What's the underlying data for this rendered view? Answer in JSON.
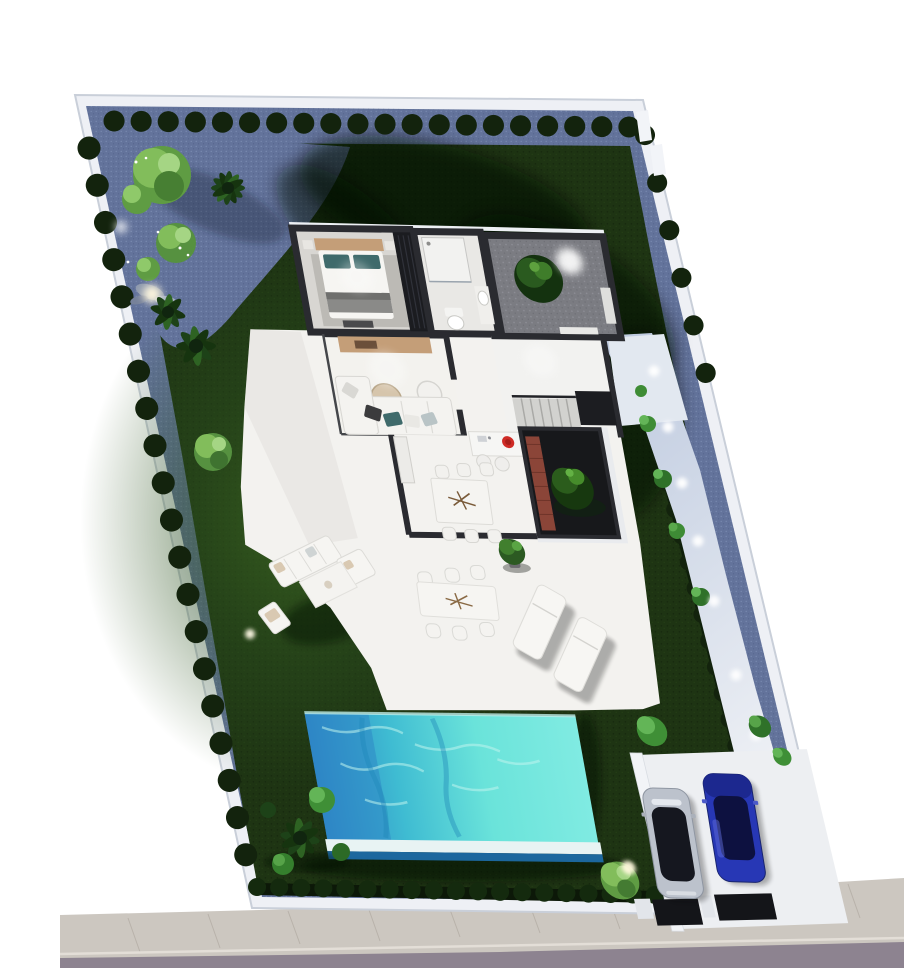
{
  "scene": {
    "description": "Aerial top-down 3D architectural render of a walled villa plot with garden, swimming pool, furnished interior, terrace and private parking",
    "view": "top-down dollhouse aerial view",
    "lighting": "dusk render with garden and wall spotlights",
    "visible_text": "none"
  },
  "palette": {
    "background": "#ffffff",
    "plot_wall": "#eef0f5",
    "gravel": "#63739b",
    "lawn": "#1e3413",
    "lawn_light": "#3c6621",
    "hedge": "#13230d",
    "tree_light": "#82bd5b",
    "tree_dark": "#10250f",
    "path_stone": "#c6d0e2",
    "terrace": "#f3f2ef",
    "house_wall": "#2a2b30",
    "bedroom_floor": "#d8d6d2",
    "courtyard_floor": "#7b7c82",
    "brick": "#8b4538",
    "wood": "#c49e78",
    "pool_deep": "#2e86c6",
    "pool_mid": "#3fbcd2",
    "pool_aqua": "#6ae3da",
    "pool_rim": "#e8f3f3",
    "sidewalk": "#ccc7c0",
    "road": "#8d8390",
    "car_silver": "#bcc2cc",
    "car_glass": "#15171f",
    "car_blue": "#2737b5",
    "cooktop_red": "#cf2b25",
    "pillow_teal": "#3f6a6b",
    "glow": "#ffffff"
  },
  "plot": {
    "shape": "parallelogram walled plot",
    "boundary_wall": "white perimeter wall",
    "perimeter_planting": "rows of clipped round hedge bushes along top and left walls",
    "side_path": "blue-grey stone path with wall lights along right boundary",
    "rock_garden": "gravel garden with clipped trees, rocks, palms and spotlights in top-left corner"
  },
  "house": {
    "rooms": [
      {
        "name": "bedroom",
        "furniture": [
          "double bed",
          "tan headboard",
          "teal pillows",
          "grey throw",
          "area rug",
          "nightstands",
          "foot bench",
          "dark wardrobe"
        ]
      },
      {
        "name": "bathroom",
        "furniture": [
          "walk-in shower",
          "washbasin counter",
          "toilet"
        ]
      },
      {
        "name": "entrance-courtyard",
        "features": [
          "gravel floor",
          "ornamental tree",
          "spotlight",
          "white doormat",
          "planter"
        ]
      },
      {
        "name": "living-room",
        "furniture": [
          "wood media sideboard",
          "round pouf table",
          "round side table",
          "armchair",
          "L-shaped white sofa",
          "scatter cushions"
        ]
      },
      {
        "name": "hall",
        "furniture": [
          "staircase with dark landing",
          "railing"
        ]
      },
      {
        "name": "kitchen",
        "furniture": [
          "white island with red cooktop and sink",
          "two stools",
          "wall counter"
        ]
      },
      {
        "name": "dining-room",
        "furniture": [
          "white table with branch centerpiece",
          "six chairs"
        ]
      },
      {
        "name": "inner-courtyard",
        "features": [
          "dark floor",
          "brick feature wall",
          "ornamental tree",
          "white surround wall"
        ]
      }
    ]
  },
  "outdoor": {
    "terrace_furniture": [
      "outdoor lounge sofa",
      "outdoor love seat",
      "white outdoor rug",
      "outdoor side table",
      "outdoor armchair",
      "outdoor dining table",
      "six dining chairs",
      "two sun loungers",
      "potted plant"
    ],
    "pool": {
      "shape": "rectangular",
      "water": "turquoise with ripples and deep blue end",
      "edge": "white overflow rim"
    },
    "lawn_spotlights": 2,
    "wall_lights_right_path": 7,
    "parking": {
      "surface": "white concrete pad",
      "cars": [
        {
          "name": "car-1",
          "color": "silver with black glass roof"
        },
        {
          "name": "car-2",
          "color": "royal blue"
        }
      ],
      "driveway": "two dark paving strips crossing the sidewalk",
      "tree_with_uplight": 1
    },
    "street": {
      "sidewalk": "light grey pavers with seams",
      "road": "grey asphalt strip at bottom"
    }
  }
}
